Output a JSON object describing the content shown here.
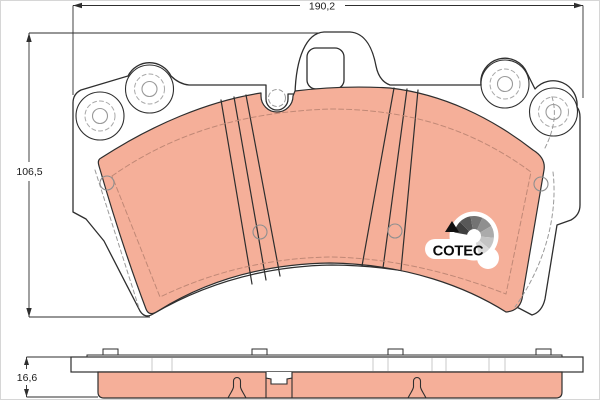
{
  "drawing": {
    "kind": "brake-pad technical drawing",
    "views": [
      "face-view",
      "side-profile-view"
    ]
  },
  "dimensions": {
    "width_label": "190,2",
    "height_label": "106,5",
    "thickness_label": "16,6"
  },
  "logo": {
    "text": "COTEC",
    "fan_colors": [
      "#3f3f3f",
      "#585858",
      "#737373",
      "#8f8f8f",
      "#ababab",
      "#c4c4c4",
      "#d9d9d9"
    ]
  },
  "colors": {
    "friction_material": "#F5AF99",
    "backplate": "#ffffff",
    "outline": "#2e2e2e",
    "hidden_line_on_pad": "#c08876",
    "hidden_line_gray": "#9a9a9a",
    "plate_tick": "#c8c8c8",
    "page_border": "#d6d6d6"
  }
}
